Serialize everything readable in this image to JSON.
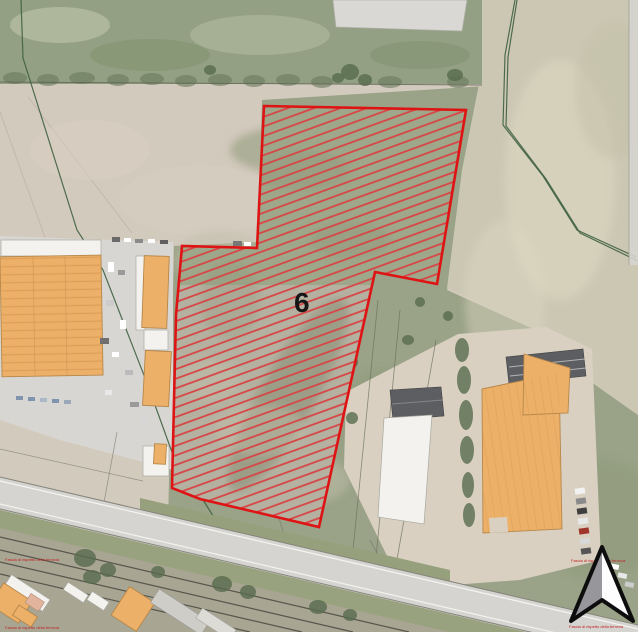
{
  "map": {
    "zone": {
      "label": "6"
    },
    "watermarks": {
      "left_top": "Fascia di rispetto della ferrovia",
      "left_bottom": "Fascia di rispetto della ferrovia",
      "right_top": "Fascia di rispetto della ferrovia",
      "right_bottom": "Fascia di rispetto della ferrovia"
    }
  },
  "colors": {
    "zone-border": "#de1414",
    "zone-hatch": "#d74545",
    "building-orange": "#edb069",
    "building-stroke": "#b5874a",
    "parcel-line-green": "#3f6040",
    "annotation-red": "#c22222",
    "compass-gray": "#97979b"
  }
}
